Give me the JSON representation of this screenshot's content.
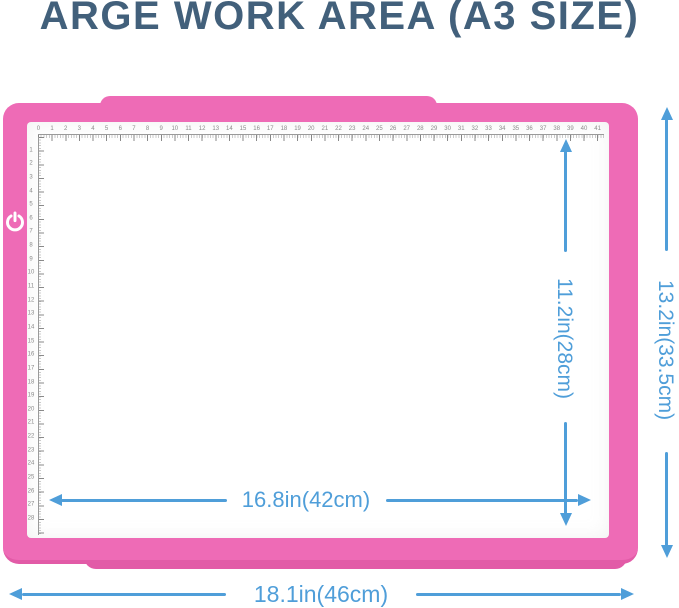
{
  "title": "ARGE WORK AREA (A3 SIZE)",
  "colors": {
    "frame_pink": "#ee6bb6",
    "frame_pink_dark": "#e25ba7",
    "arrow_blue": "#4f9ed9",
    "title_color": "#42607b"
  },
  "pad": {
    "power_icon": "power-icon"
  },
  "ruler": {
    "unit": "cm",
    "top_numbers": [
      "0",
      "1",
      "2",
      "3",
      "4",
      "5",
      "6",
      "7",
      "8",
      "9",
      "10",
      "11",
      "12",
      "13",
      "14",
      "15",
      "16",
      "17",
      "18",
      "19",
      "20",
      "21",
      "22",
      "23",
      "24",
      "25",
      "26",
      "27",
      "28",
      "29",
      "30",
      "31",
      "32",
      "33",
      "34",
      "35",
      "36",
      "37",
      "38",
      "39",
      "40",
      "41"
    ],
    "left_numbers": [
      "1",
      "2",
      "3",
      "4",
      "5",
      "6",
      "7",
      "8",
      "9",
      "10",
      "11",
      "12",
      "13",
      "14",
      "15",
      "16",
      "17",
      "18",
      "19",
      "20",
      "21",
      "22",
      "23",
      "24",
      "25",
      "26",
      "27",
      "28"
    ]
  },
  "dimensions": {
    "work_width": "16.8in(42cm)",
    "work_height": "11.2in(28cm)",
    "outer_width": "18.1in(46cm)",
    "outer_height": "13.2in(33.5cm)"
  }
}
